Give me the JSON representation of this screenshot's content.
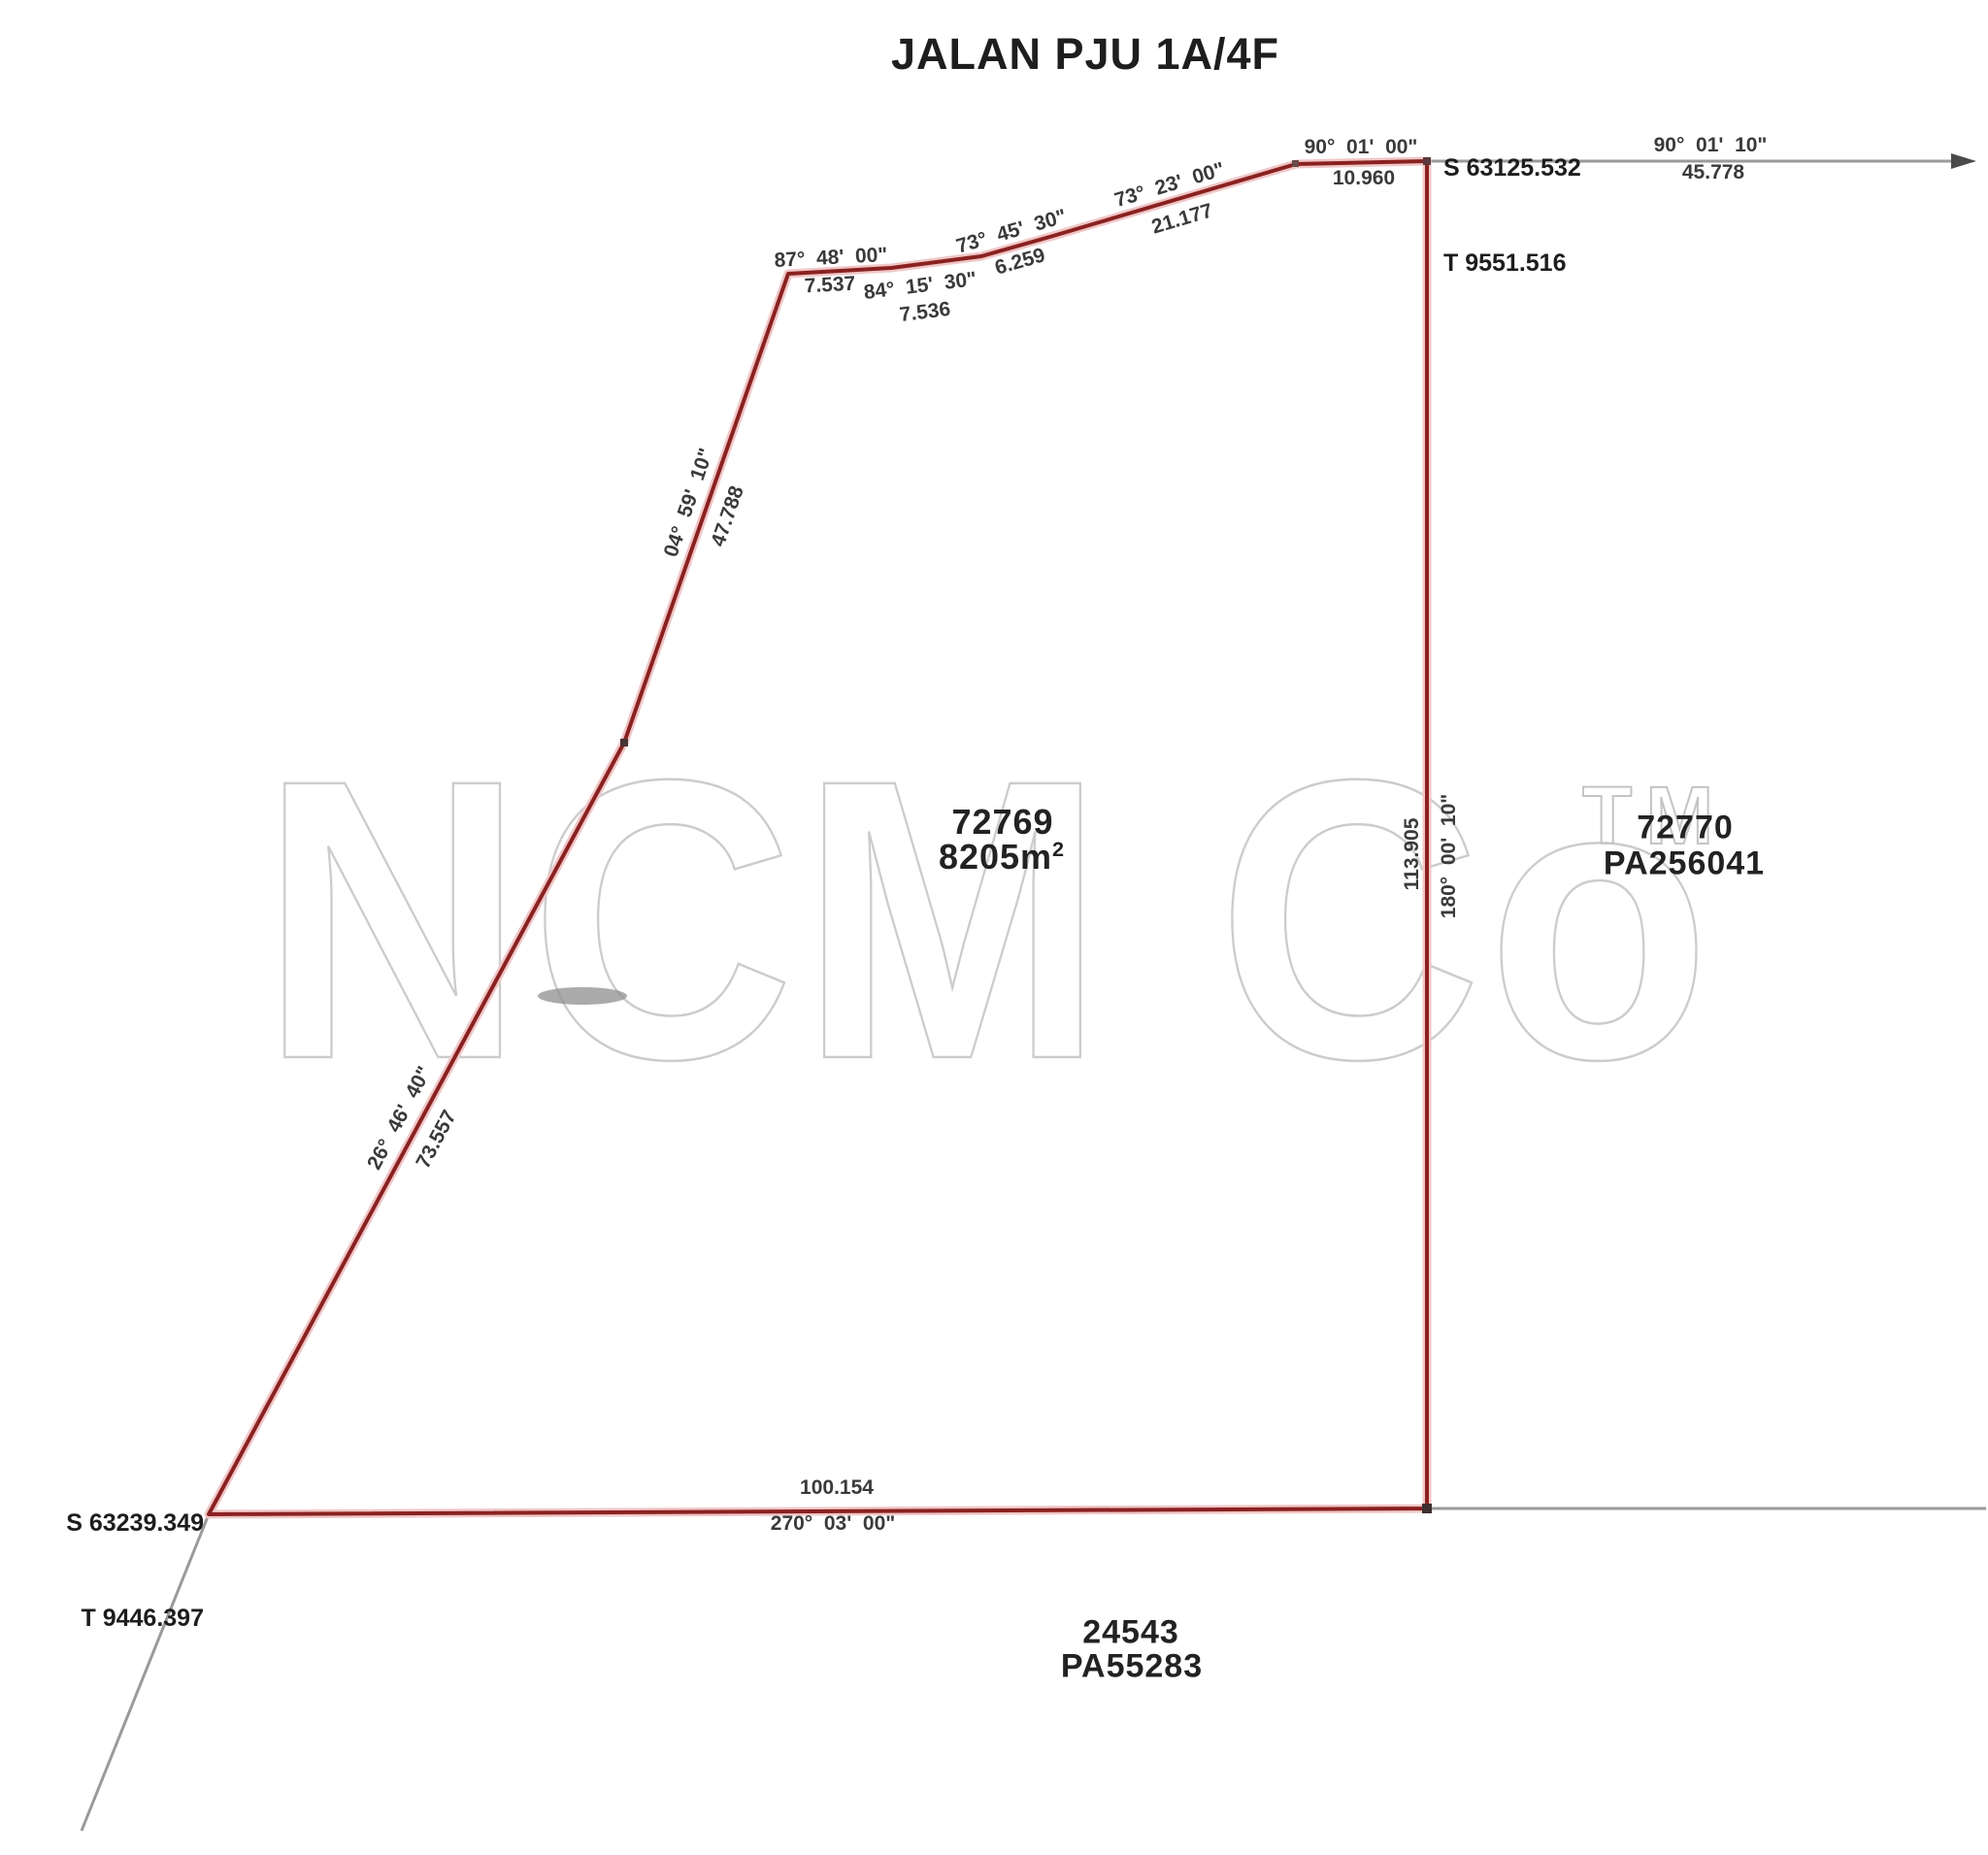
{
  "title": "JALAN PJU 1A/4F",
  "watermark": {
    "text": "NCM Co",
    "tm": "TM"
  },
  "stations": {
    "northeast": {
      "s": "S 63125.532",
      "t": "T 9551.516"
    },
    "southwest": {
      "s": "S 63239.349",
      "t": "T 9446.397"
    }
  },
  "lots": {
    "subject": {
      "number": "72769",
      "area_value": "8205m",
      "area_exp": "2"
    },
    "east": {
      "number": "72770",
      "plan": "PA256041"
    },
    "south": {
      "number": "24543",
      "plan": "PA55283"
    }
  },
  "segments": {
    "road_east": {
      "bearing": "90°  01'  10\"",
      "distance": "45.778"
    },
    "top_1": {
      "bearing": "90°  01'  00\"",
      "distance": "10.960"
    },
    "top_2": {
      "bearing": "73°  23'  00\"",
      "distance": "21.177"
    },
    "top_3": {
      "bearing": "73°  45'  30\"",
      "distance": "6.259"
    },
    "top_4": {
      "bearing": "84°  15'  30\"",
      "distance": "7.536"
    },
    "top_5": {
      "bearing": "87°  48'  00\"",
      "distance": "7.537"
    },
    "west_upper": {
      "bearing": "04°  59'  10\"",
      "distance": "47.788"
    },
    "west_lower": {
      "bearing": "26°  46'  40\"",
      "distance": "73.557"
    },
    "east_side": {
      "bearing": "180°  00'  10\"",
      "distance": "113.905"
    },
    "south_side": {
      "bearing": "270°  03'  00\"",
      "distance": "100.154"
    }
  },
  "colors": {
    "boundary": "#8a2121",
    "boundary_halo": "#f0c6c6",
    "reference_line": "#9a9a9a",
    "text": "#3a3a3a",
    "watermark": "#cccccc"
  }
}
